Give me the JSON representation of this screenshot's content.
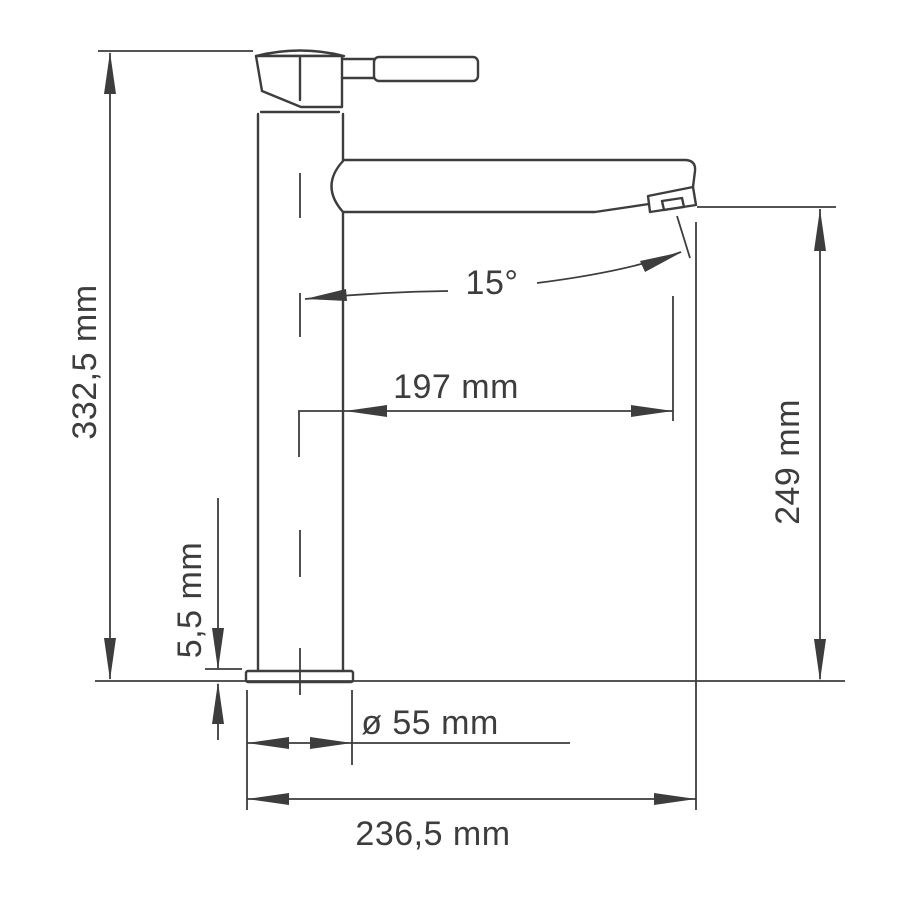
{
  "page": {
    "background": "#ffffff",
    "ink_color": "#3d3d3d"
  },
  "diagram": {
    "subject": "single-lever basin mixer faucet, side elevation dimension drawing",
    "labels": {
      "total_height": "332,5 mm",
      "spout_angle": "15°",
      "spout_reach": "197 mm",
      "spout_outlet_height": "249 mm",
      "base_plate_thickness": "5,5 mm",
      "base_diameter": "ø 55 mm",
      "overall_depth": "236,5 mm"
    }
  }
}
